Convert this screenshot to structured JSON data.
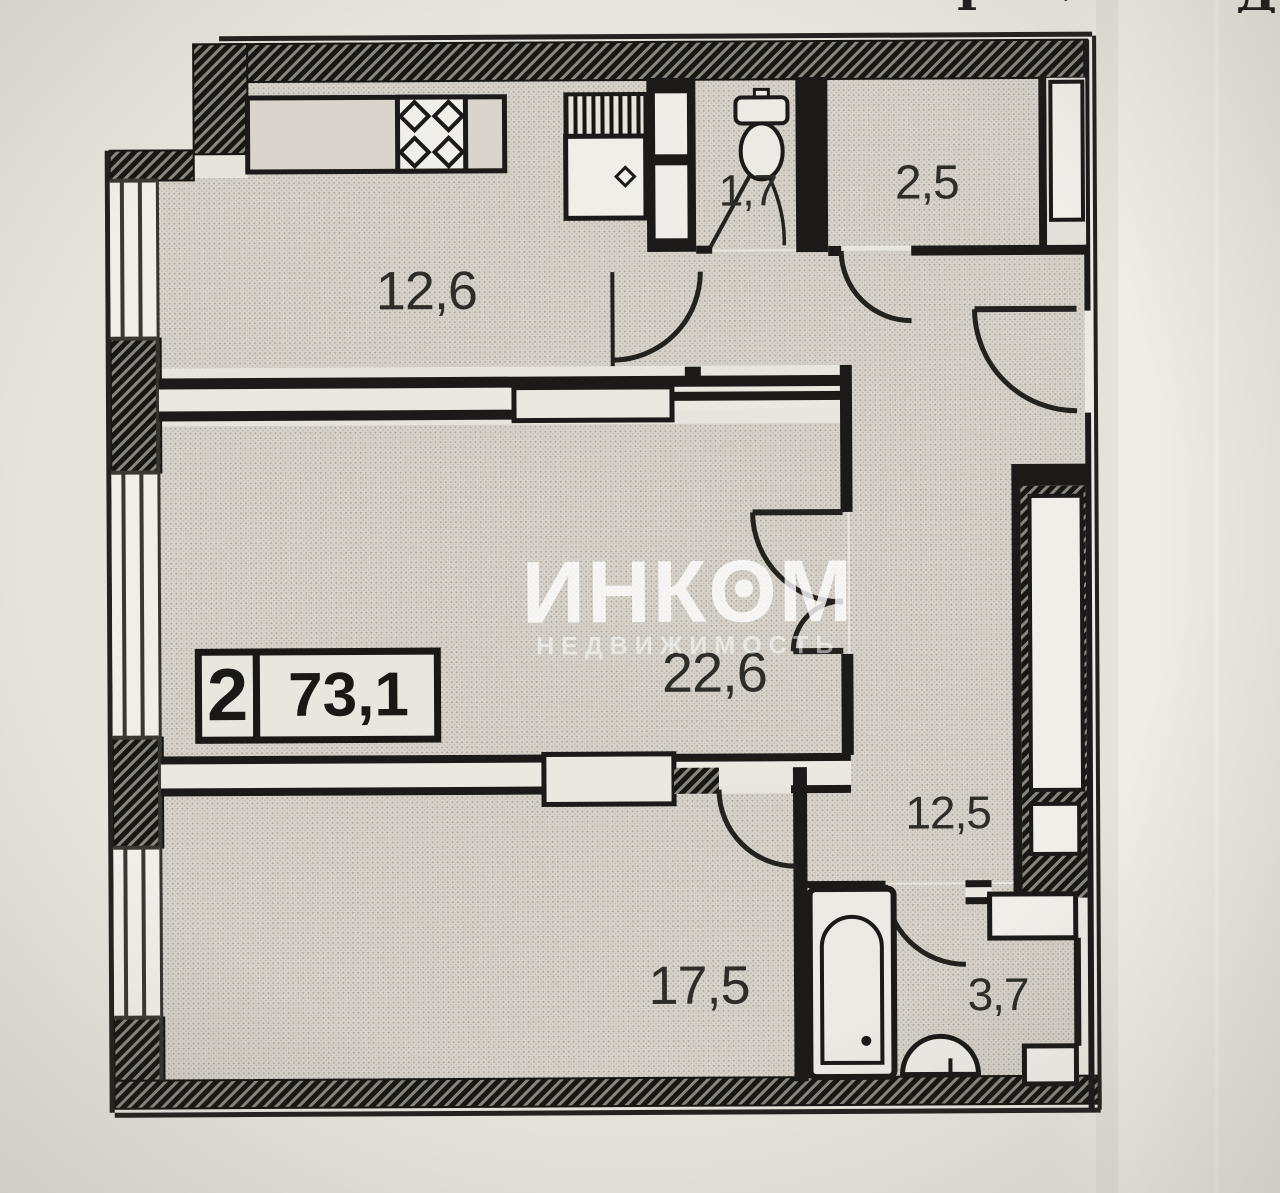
{
  "badge": {
    "rooms_count": "2",
    "total_area": "73,1"
  },
  "watermark": {
    "brand": "ИНКОМ",
    "tagline": "НЕДВИЖИМОСТЬ"
  },
  "rooms": {
    "kitchen": {
      "area": "12,6"
    },
    "wc": {
      "area": "1,7"
    },
    "storage": {
      "area": "2,5"
    },
    "living": {
      "area": "22,6"
    },
    "hallway": {
      "area": "12,5"
    },
    "bedroom": {
      "area": "17,5"
    },
    "bathroom": {
      "area": "3,7"
    }
  },
  "photo": {
    "top_fragments": [
      "Т",
      "˒",
      "Д"
    ]
  },
  "icons": {
    "stove": "stove-4-burner-icon",
    "kitchen_sink": "kitchen-sink-unit-icon",
    "toilet": "toilet-icon",
    "bathtub": "bathtub-icon",
    "washbasin": "washbasin-icon",
    "windows": "window-triple-line-icon",
    "doors": "door-swing-arc-icon"
  },
  "colors": {
    "paper": "#e9e6e0",
    "floor": "#d6d2ca",
    "wall": "#1b1a18",
    "hatch": "#8a867e",
    "fixture_fill": "#f0eee9",
    "label": "#2e2d2a",
    "watermark": "#ffffff"
  }
}
